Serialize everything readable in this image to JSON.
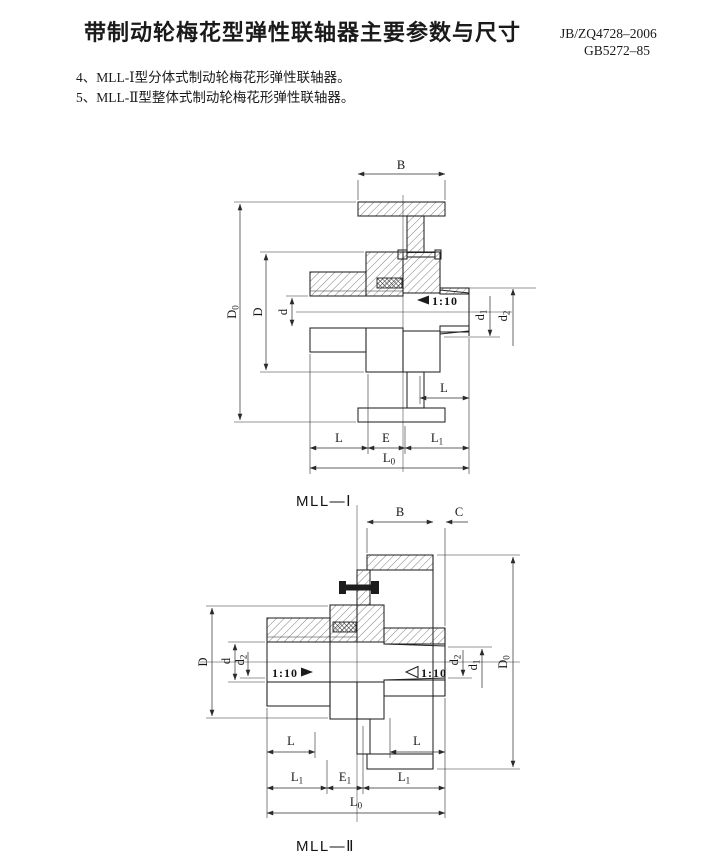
{
  "header": {
    "title": "带制动轮梅花型弹性联轴器主要参数与尺寸",
    "standard_1": "JB/ZQ4728–2006",
    "standard_2": "GB5272–85",
    "item_4": "4、MLL-Ⅰ型分体式制动轮梅花形弹性联轴器。",
    "item_5": "5、MLL-Ⅱ型整体式制动轮梅花形弹性联轴器。"
  },
  "drawing1": {
    "caption": "MLL—Ⅰ",
    "dims": {
      "B": "B",
      "D": "D",
      "d": "d",
      "E": "E",
      "L": "L",
      "L_right": "L",
      "taper": "1:10",
      "D0": {
        "m": "D",
        "s": "0"
      },
      "d1": {
        "m": "d",
        "s": "1"
      },
      "d2": {
        "m": "d",
        "s": "2"
      },
      "L1": {
        "m": "L",
        "s": "1"
      },
      "L0": {
        "m": "L",
        "s": "0"
      }
    }
  },
  "drawing2": {
    "caption": "MLL—Ⅱ",
    "dims": {
      "B": "B",
      "C": "C",
      "D": "D",
      "d": "d",
      "taper_left": "1:10",
      "taper_right": "1:10",
      "L_left": "L",
      "L_right": "L",
      "D0": {
        "m": "D",
        "s": "0"
      },
      "d1": {
        "m": "d",
        "s": "1"
      },
      "d2_left": {
        "m": "d",
        "s": "2"
      },
      "d2_right": {
        "m": "d",
        "s": "2"
      },
      "L1_left": {
        "m": "L",
        "s": "1"
      },
      "L1_right": {
        "m": "L",
        "s": "1"
      },
      "E1": {
        "m": "E",
        "s": "1"
      },
      "L0": {
        "m": "L",
        "s": "0"
      }
    }
  }
}
